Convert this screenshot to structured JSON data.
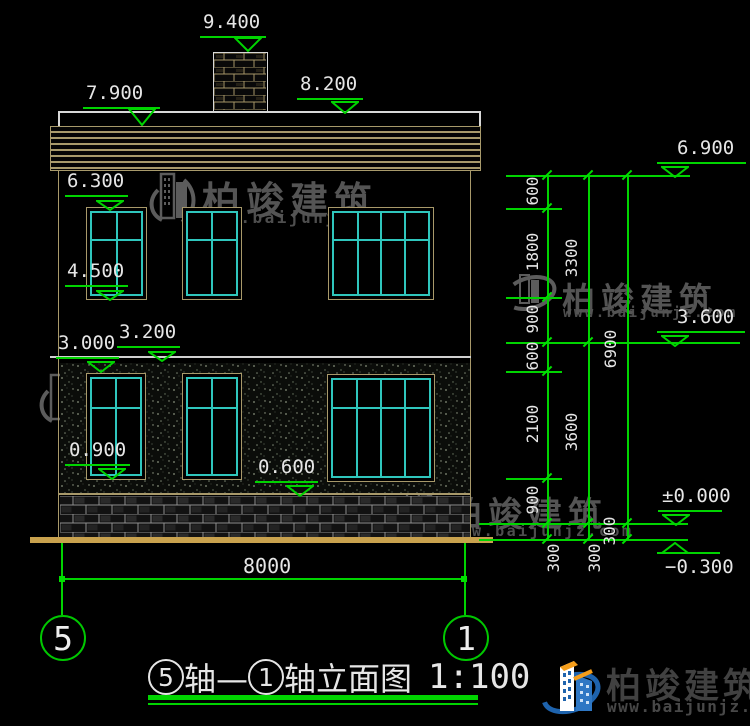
{
  "title": {
    "axis_bubble_start": "5",
    "mid_text": "轴—",
    "axis_bubble_end": "1",
    "suffix_text": "轴立面图",
    "scale": "1:100"
  },
  "bottom_dimension": {
    "label": "8000"
  },
  "axis_bubbles": [
    {
      "label": "5"
    },
    {
      "label": "1"
    }
  ],
  "watermarks": [
    {
      "name": "柏竣建筑",
      "url": "www.baijunjz.com"
    },
    {
      "name": "柏竣建筑",
      "url": "www.baijunjz.com"
    },
    {
      "name": "柏竣建筑",
      "url": "www.baijunjz.com"
    },
    {
      "name": "柏竣建筑",
      "url": "www.baijunjz.com"
    }
  ],
  "brand": {
    "name": "柏竣建筑",
    "url": "www.baijunjz.com"
  },
  "colors": {
    "green": "#00d400",
    "cyan": "#2fc6bd",
    "tan": "#a8996a",
    "ground_tan": "#c9a24e",
    "white": "#e6e6e6",
    "watermark_gray": "#5c5c5c",
    "logo_blue": "#2e77c4",
    "logo_dark_blue": "#1e63ad",
    "logo_orange": "#f59e1b"
  },
  "elevation_marks": [
    {
      "label": "9.400",
      "x1": 200,
      "x2": 266,
      "y": 36,
      "tip": 52,
      "tx": 203,
      "ta": "right"
    },
    {
      "label": "8.200",
      "x1": 297,
      "x2": 363,
      "y": 98,
      "tip": 112,
      "tx": 300,
      "ta": "right"
    },
    {
      "label": "7.900",
      "x1": 83,
      "x2": 160,
      "y": 107,
      "tip": 126,
      "tx": 86,
      "ta": "right"
    },
    {
      "label": "6.300",
      "x1": 65,
      "x2": 128,
      "y": 195,
      "tip": 207,
      "tx": 67,
      "ta": "right"
    },
    {
      "label": "4.500",
      "x1": 65,
      "x2": 128,
      "y": 285,
      "tip": 297,
      "tx": 67,
      "ta": "right"
    },
    {
      "label": "3.200",
      "x1": 117,
      "x2": 180,
      "y": 346,
      "tip": 358,
      "tx": 119,
      "ta": "right"
    },
    {
      "label": "3.000",
      "x1": 56,
      "x2": 119,
      "y": 357,
      "tip": 370,
      "tx": 58,
      "ta": "right"
    },
    {
      "label": "0.900",
      "x1": 65,
      "x2": 130,
      "y": 464,
      "tip": 477,
      "tx": 69,
      "ta": "right"
    },
    {
      "label": "0.600",
      "x1": 255,
      "x2": 318,
      "y": 481,
      "tip": 494,
      "tx": 258,
      "ta": "right"
    },
    {
      "label": "6.900",
      "x1": 657,
      "x2": 746,
      "y": 162,
      "tip": 175,
      "tx": 677,
      "ta": "left"
    },
    {
      "label": "3.600",
      "x1": 657,
      "x2": 745,
      "y": 331,
      "tip": 344,
      "tx": 677,
      "ta": "left"
    },
    {
      "label": "±0.000",
      "x1": 658,
      "x2": 722,
      "y": 510,
      "tip": 523,
      "tx": 662,
      "ta": "left"
    },
    {
      "label": "−0.300",
      "x1": 657,
      "x2": 720,
      "y": 552,
      "tip": 539,
      "tx": 665,
      "ta": "left",
      "flip": true
    }
  ],
  "dimension_chains": [
    {
      "x": 547,
      "segments": [
        {
          "label": "600",
          "y1": 175,
          "y2": 208,
          "lx": 533,
          "ly": 191
        },
        {
          "label": "1800",
          "y1": 208,
          "y2": 297,
          "lx": 533,
          "ly": 252
        },
        {
          "label": "900",
          "y1": 297,
          "y2": 342,
          "lx": 533,
          "ly": 319
        },
        {
          "label": "600",
          "y1": 342,
          "y2": 371,
          "lx": 533,
          "ly": 356
        },
        {
          "label": "2100",
          "y1": 371,
          "y2": 478,
          "lx": 533,
          "ly": 424
        },
        {
          "label": "900",
          "y1": 478,
          "y2": 523,
          "lx": 533,
          "ly": 500
        },
        {
          "label": "300",
          "y1": 523,
          "y2": 539,
          "lx": 554,
          "ly": 558
        }
      ]
    },
    {
      "x": 588,
      "segments": [
        {
          "label": "3300",
          "y1": 175,
          "y2": 342,
          "lx": 572,
          "ly": 258
        },
        {
          "label": "3600",
          "y1": 342,
          "y2": 523,
          "lx": 572,
          "ly": 432
        },
        {
          "label": "300",
          "y1": 523,
          "y2": 539,
          "lx": 595,
          "ly": 558
        }
      ]
    },
    {
      "x": 627,
      "segments": [
        {
          "label": "6900",
          "y1": 175,
          "y2": 523,
          "lx": 611,
          "ly": 349
        },
        {
          "label": "300",
          "y1": 523,
          "y2": 539,
          "lx": 610,
          "ly": 531
        }
      ]
    }
  ],
  "extension_lines": [
    {
      "x1": 506,
      "x2": 690,
      "y": 175
    },
    {
      "x1": 506,
      "x2": 562,
      "y": 208
    },
    {
      "x1": 506,
      "x2": 562,
      "y": 297
    },
    {
      "x1": 506,
      "x2": 740,
      "y": 342
    },
    {
      "x1": 506,
      "x2": 562,
      "y": 371
    },
    {
      "x1": 506,
      "x2": 562,
      "y": 478
    },
    {
      "x1": 479,
      "x2": 688,
      "y": 523
    },
    {
      "x1": 479,
      "x2": 688,
      "y": 539
    }
  ],
  "windows": [
    {
      "x": 86,
      "y": 207,
      "w": 59,
      "h": 91,
      "cols": 2,
      "transom": 0.33
    },
    {
      "x": 182,
      "y": 207,
      "w": 58,
      "h": 91,
      "cols": 2,
      "transom": 0.33
    },
    {
      "x": 328,
      "y": 207,
      "w": 104,
      "h": 91,
      "cols": 4,
      "transom": 0.33
    },
    {
      "x": 86,
      "y": 373,
      "w": 58,
      "h": 105,
      "cols": 2,
      "transom": 0.3
    },
    {
      "x": 182,
      "y": 373,
      "w": 58,
      "h": 105,
      "cols": 2,
      "transom": 0.3
    },
    {
      "x": 327,
      "y": 374,
      "w": 106,
      "h": 106,
      "cols": 4,
      "transom": 0.29
    }
  ]
}
